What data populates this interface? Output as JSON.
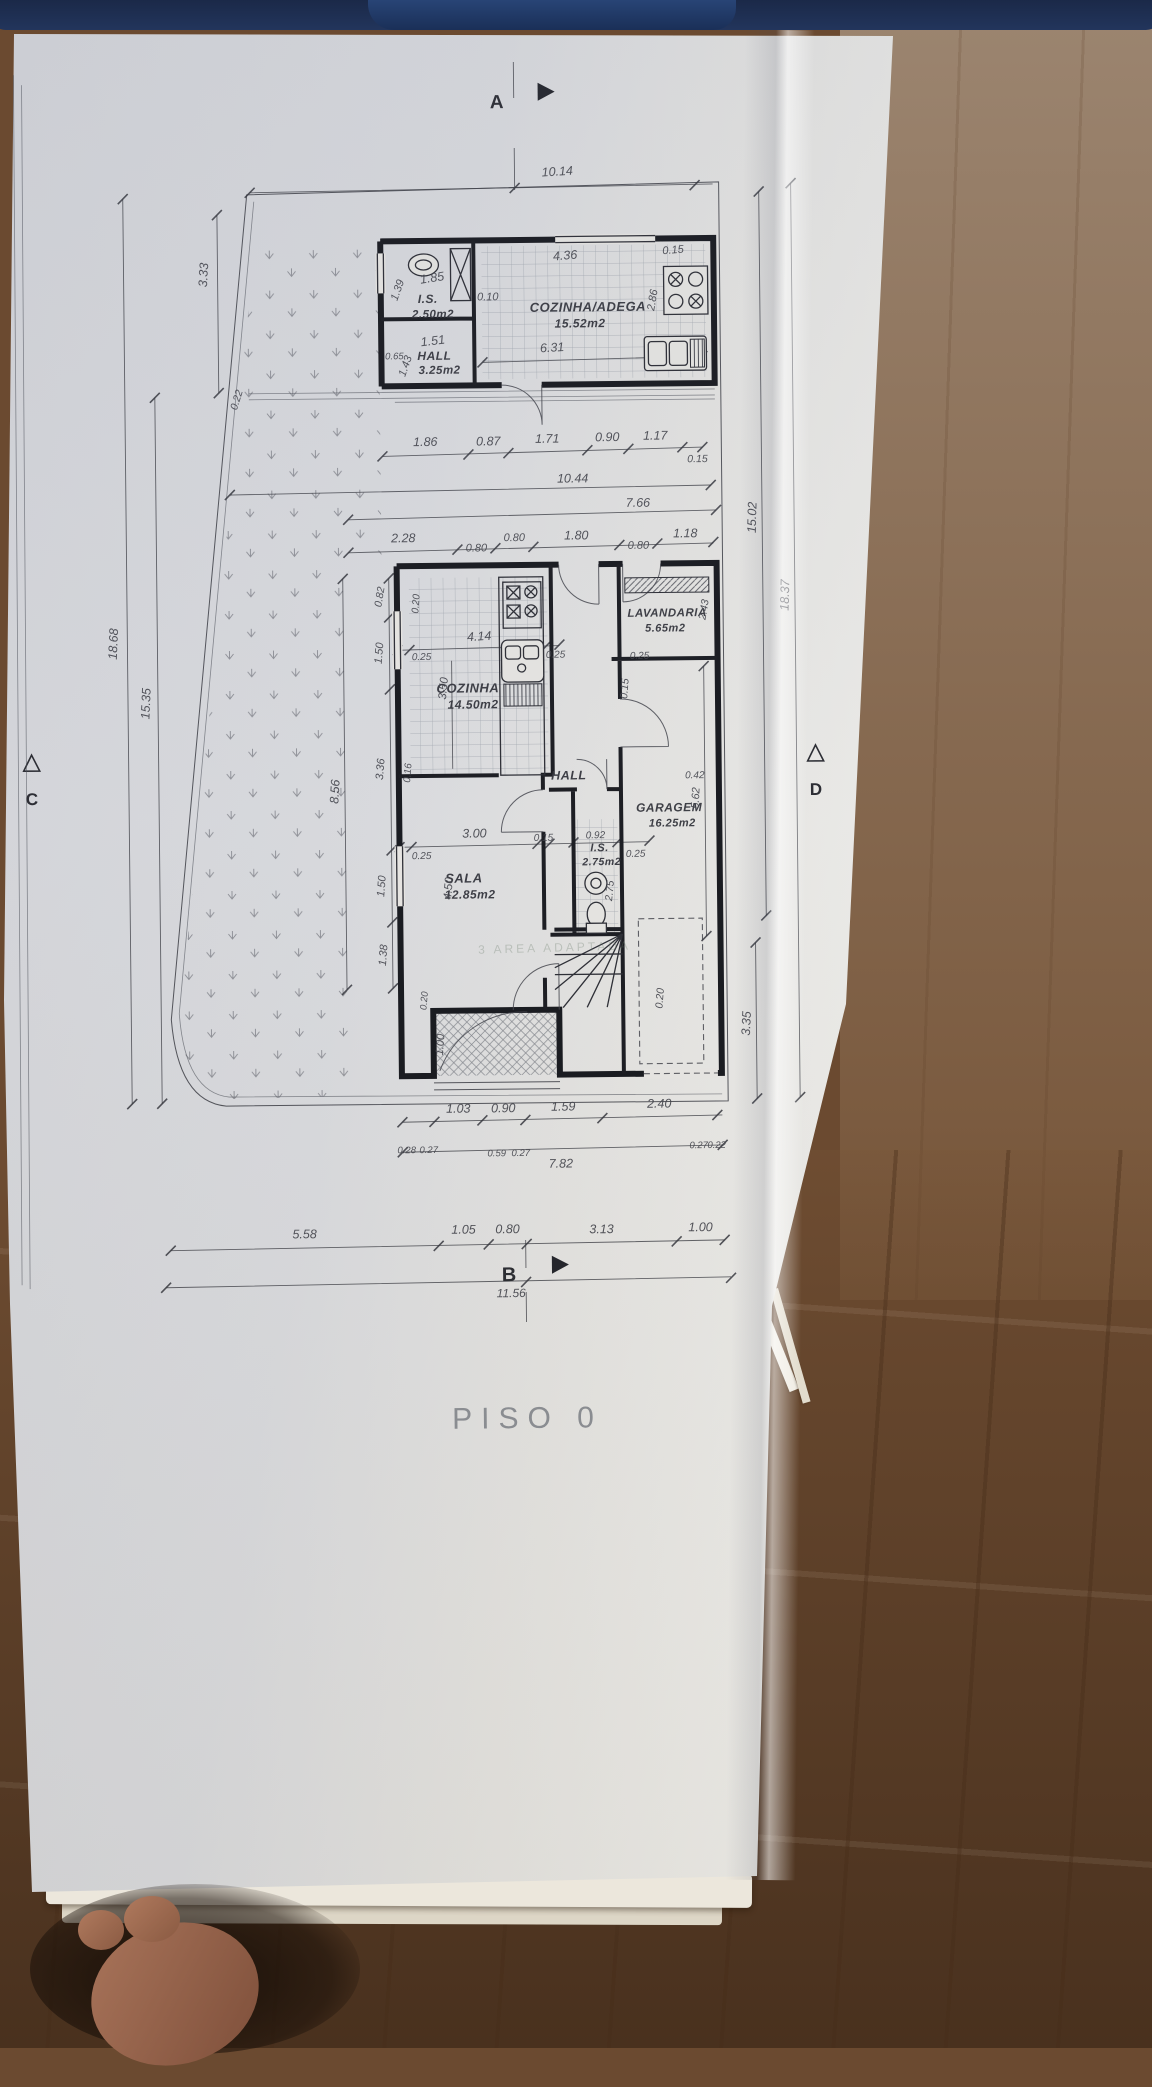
{
  "meta": {
    "title": "PISO 0",
    "drawing_type": "architectural floor plan, ground floor"
  },
  "rooms": [
    {
      "name": "I.S.",
      "area": "2.50m2"
    },
    {
      "name": "HALL",
      "area": "3.25m2"
    },
    {
      "name": "COZINHA/ADEGA",
      "area": "15.52m2"
    },
    {
      "name": "COZINHA",
      "area": "14.50m2"
    },
    {
      "name": "LAVANDARIA",
      "area": "5.65m2"
    },
    {
      "name": "HALL",
      "area": ""
    },
    {
      "name": "I.S.",
      "area": "2.75m2"
    },
    {
      "name": "GARAGEM",
      "area": "16.25m2"
    },
    {
      "name": "SALA",
      "area": "12.85m2"
    }
  ],
  "section_markers": [
    "A",
    "B",
    "C",
    "D"
  ],
  "overall_dimensions": {
    "top_width": "10.14",
    "bottom_segments": [
      "5.58",
      "1.05",
      "0.80",
      "3.13",
      "1.00"
    ],
    "bottom_total": "11.56",
    "left": [
      "3.33",
      "18.68",
      "15.35"
    ],
    "right": [
      "15.02",
      "18.37",
      "3.35"
    ]
  },
  "plan": {
    "labels": [
      {
        "t": "A",
        "x": 503,
        "y": 108,
        "s": 19,
        "c": "marker"
      },
      {
        "t": "B",
        "x": 503,
        "y": 1281,
        "s": 20,
        "c": "marker"
      },
      {
        "t": "C",
        "x": 31,
        "y": 800,
        "s": 17,
        "c": "marker"
      },
      {
        "t": "D",
        "x": 815,
        "y": 798,
        "s": 17,
        "c": "marker"
      },
      {
        "t": "PISO  0",
        "x": 520,
        "y": 1428,
        "s": 30,
        "c": "title"
      },
      {
        "t": "3  AREA  ADAPTADA",
        "x": 552,
        "y": 952,
        "s": 12,
        "c": "stamp",
        "r": -1
      },
      {
        "t": "10.14",
        "x": 563,
        "y": 176,
        "r": -3
      },
      {
        "t": "3.33",
        "x": 212,
        "y": 272,
        "r": -86
      },
      {
        "t": "18.68",
        "x": 118,
        "y": 640,
        "r": -87
      },
      {
        "t": "15.35",
        "x": 150,
        "y": 700,
        "r": -87
      },
      {
        "t": "0.22",
        "x": 243,
        "y": 398,
        "r": -72,
        "s": 10.5
      },
      {
        "t": "15.02",
        "x": 758,
        "y": 520,
        "r": -88
      },
      {
        "t": "18.37",
        "x": 790,
        "y": 598,
        "r": -88
      },
      {
        "t": "3.35",
        "x": 747,
        "y": 1026,
        "r": -87
      },
      {
        "t": "1.39",
        "x": 405,
        "y": 290,
        "r": -70,
        "s": 11
      },
      {
        "t": "1.85",
        "x": 437,
        "y": 281,
        "r": -8
      },
      {
        "t": "I.S.",
        "x": 432,
        "y": 302,
        "s": 12,
        "c": "room"
      },
      {
        "t": "2.50m2",
        "x": 437,
        "y": 317,
        "s": 11.5,
        "c": "room"
      },
      {
        "t": "1.51",
        "x": 437,
        "y": 344,
        "r": -6
      },
      {
        "t": "0.65",
        "x": 398,
        "y": 358,
        "s": 9.5
      },
      {
        "t": "HALL",
        "x": 438,
        "y": 359,
        "s": 12,
        "c": "room"
      },
      {
        "t": "3.25m2",
        "x": 443,
        "y": 373,
        "s": 11.5,
        "c": "room"
      },
      {
        "t": "1.43",
        "x": 412,
        "y": 366,
        "r": -70,
        "s": 11
      },
      {
        "t": "0.10",
        "x": 492,
        "y": 300,
        "s": 11
      },
      {
        "t": "4.36",
        "x": 570,
        "y": 260,
        "r": -4
      },
      {
        "t": "0.15",
        "x": 678,
        "y": 255,
        "s": 11,
        "r": -4
      },
      {
        "t": "COZINHA/ADEGA",
        "x": 592,
        "y": 312,
        "s": 13,
        "c": "room"
      },
      {
        "t": "15.52m2",
        "x": 584,
        "y": 328,
        "s": 12,
        "c": "room"
      },
      {
        "t": "2.86",
        "x": 660,
        "y": 302,
        "r": -80,
        "s": 11
      },
      {
        "t": "6.31",
        "x": 556,
        "y": 352,
        "r": -3
      },
      {
        "t": "1.86",
        "x": 428,
        "y": 445
      },
      {
        "t": "0.87",
        "x": 491,
        "y": 445
      },
      {
        "t": "1.71",
        "x": 550,
        "y": 443
      },
      {
        "t": "0.90",
        "x": 610,
        "y": 442
      },
      {
        "t": "1.17",
        "x": 658,
        "y": 441
      },
      {
        "t": "0.15",
        "x": 700,
        "y": 464,
        "s": 10.5
      },
      {
        "t": "10.44",
        "x": 575,
        "y": 483
      },
      {
        "t": "7.66",
        "x": 640,
        "y": 508
      },
      {
        "t": "2.28",
        "x": 405,
        "y": 541
      },
      {
        "t": "0.80",
        "x": 478,
        "y": 551,
        "s": 11
      },
      {
        "t": "0.80",
        "x": 516,
        "y": 541,
        "s": 11
      },
      {
        "t": "1.80",
        "x": 578,
        "y": 540
      },
      {
        "t": "0.80",
        "x": 640,
        "y": 550,
        "s": 11
      },
      {
        "t": "1.18",
        "x": 687,
        "y": 539
      },
      {
        "t": "0.82",
        "x": 384,
        "y": 596,
        "r": -80,
        "s": 10.5
      },
      {
        "t": "0.20",
        "x": 420,
        "y": 603,
        "r": -85,
        "s": 10
      },
      {
        "t": "4.14",
        "x": 480,
        "y": 640,
        "r": -3
      },
      {
        "t": "0.25",
        "x": 422,
        "y": 659,
        "s": 10
      },
      {
        "t": "0.25",
        "x": 556,
        "y": 658,
        "s": 10
      },
      {
        "t": "0.25",
        "x": 640,
        "y": 660,
        "s": 10
      },
      {
        "t": "COZINHA",
        "x": 468,
        "y": 692,
        "s": 13,
        "c": "room"
      },
      {
        "t": "14.50m2",
        "x": 473,
        "y": 708,
        "s": 12,
        "c": "room"
      },
      {
        "t": "3.50",
        "x": 447,
        "y": 688,
        "r": -84,
        "s": 11.5
      },
      {
        "t": "LAVANDARIA",
        "x": 668,
        "y": 618,
        "s": 11.5,
        "c": "room"
      },
      {
        "t": "5.65m2",
        "x": 666,
        "y": 633,
        "s": 11,
        "c": "room"
      },
      {
        "t": "2.43",
        "x": 708,
        "y": 612,
        "r": -80,
        "s": 10.5
      },
      {
        "t": "0.15",
        "x": 628,
        "y": 690,
        "r": -85,
        "s": 10.5
      },
      {
        "t": "1.50",
        "x": 383,
        "y": 652,
        "r": -85,
        "s": 11
      },
      {
        "t": "3.36",
        "x": 383,
        "y": 768,
        "r": -85,
        "s": 11
      },
      {
        "t": "8.56",
        "x": 338,
        "y": 790,
        "r": -86
      },
      {
        "t": "1.50",
        "x": 383,
        "y": 885,
        "r": -85,
        "s": 11
      },
      {
        "t": "1.38",
        "x": 384,
        "y": 954,
        "r": -85,
        "s": 11
      },
      {
        "t": "0.16",
        "x": 410,
        "y": 772,
        "r": -85,
        "s": 10
      },
      {
        "t": "0.25",
        "x": 420,
        "y": 858,
        "s": 10
      },
      {
        "t": "3.00",
        "x": 473,
        "y": 837
      },
      {
        "t": "0.15",
        "x": 542,
        "y": 841,
        "s": 10
      },
      {
        "t": "0.92",
        "x": 594,
        "y": 839,
        "s": 10
      },
      {
        "t": "0.25",
        "x": 634,
        "y": 858,
        "s": 10
      },
      {
        "t": "HALL",
        "x": 568,
        "y": 780,
        "s": 12.5,
        "c": "room"
      },
      {
        "t": "I.S.",
        "x": 598,
        "y": 852,
        "s": 11,
        "c": "room"
      },
      {
        "t": "2.75m2",
        "x": 600,
        "y": 866,
        "s": 10.5,
        "c": "room"
      },
      {
        "t": "2.75",
        "x": 611,
        "y": 892,
        "r": -84,
        "s": 10.5
      },
      {
        "t": "GARAGEM",
        "x": 668,
        "y": 813,
        "s": 12,
        "c": "room"
      },
      {
        "t": "16.25m2",
        "x": 671,
        "y": 828,
        "s": 11,
        "c": "room"
      },
      {
        "t": "5.62",
        "x": 698,
        "y": 800,
        "r": -86,
        "s": 11
      },
      {
        "t": "0.42",
        "x": 694,
        "y": 780,
        "s": 10
      },
      {
        "t": "0.20",
        "x": 660,
        "y": 1000,
        "r": -85,
        "s": 10.5
      },
      {
        "t": "SALA",
        "x": 462,
        "y": 882,
        "s": 13,
        "c": "room"
      },
      {
        "t": "12.85m2",
        "x": 468,
        "y": 898,
        "s": 12,
        "c": "room"
      },
      {
        "t": "4.50",
        "x": 450,
        "y": 888,
        "r": -85,
        "s": 11.5
      },
      {
        "t": "0.20",
        "x": 424,
        "y": 1000,
        "r": -85,
        "s": 9.5
      },
      {
        "t": "1.00",
        "x": 440,
        "y": 1044,
        "r": -85,
        "s": 11
      },
      {
        "t": "1.03",
        "x": 454,
        "y": 1112
      },
      {
        "t": "0.90",
        "x": 499,
        "y": 1112
      },
      {
        "t": "1.59",
        "x": 559,
        "y": 1111
      },
      {
        "t": "2.40",
        "x": 655,
        "y": 1109
      },
      {
        "t": "0.28",
        "x": 402,
        "y": 1152,
        "s": 9.5
      },
      {
        "t": "0.27",
        "x": 424,
        "y": 1152,
        "s": 9.5
      },
      {
        "t": "0.59",
        "x": 492,
        "y": 1156,
        "s": 9.5
      },
      {
        "t": "0.27",
        "x": 516,
        "y": 1156,
        "s": 9.5
      },
      {
        "t": "7.82",
        "x": 556,
        "y": 1168
      },
      {
        "t": "0.27",
        "x": 694,
        "y": 1150,
        "s": 9.5
      },
      {
        "t": "0.22",
        "x": 712,
        "y": 1150,
        "s": 9.5
      },
      {
        "t": "5.58",
        "x": 299,
        "y": 1236
      },
      {
        "t": "1.05",
        "x": 458,
        "y": 1233
      },
      {
        "t": "0.80",
        "x": 502,
        "y": 1233
      },
      {
        "t": "3.13",
        "x": 596,
        "y": 1234
      },
      {
        "t": "1.00",
        "x": 695,
        "y": 1233
      },
      {
        "t": "11.56",
        "x": 505,
        "y": 1297,
        "s": 12
      }
    ]
  }
}
